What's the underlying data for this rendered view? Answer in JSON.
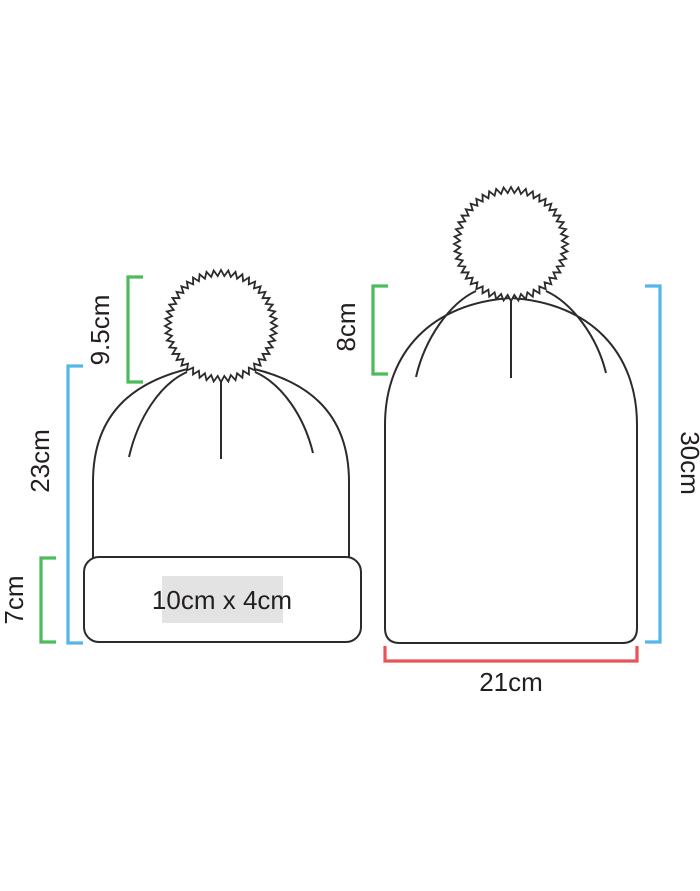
{
  "diagram": {
    "background": "#ffffff",
    "outline_color": "#2b2b2b",
    "text_color": "#231f20",
    "bracket_colors": {
      "green": "#4cbb5c",
      "blue": "#54b5e8",
      "red": "#e85456"
    },
    "print_area_bg": "#e3e3e3",
    "left_beanie": {
      "pom_height": "9.5cm",
      "hat_height": "23cm",
      "cuff_height": "7cm",
      "print_area": "10cm x 4cm"
    },
    "right_beanie": {
      "pom_height": "8cm",
      "hat_height": "30cm",
      "hat_width": "21cm"
    }
  }
}
